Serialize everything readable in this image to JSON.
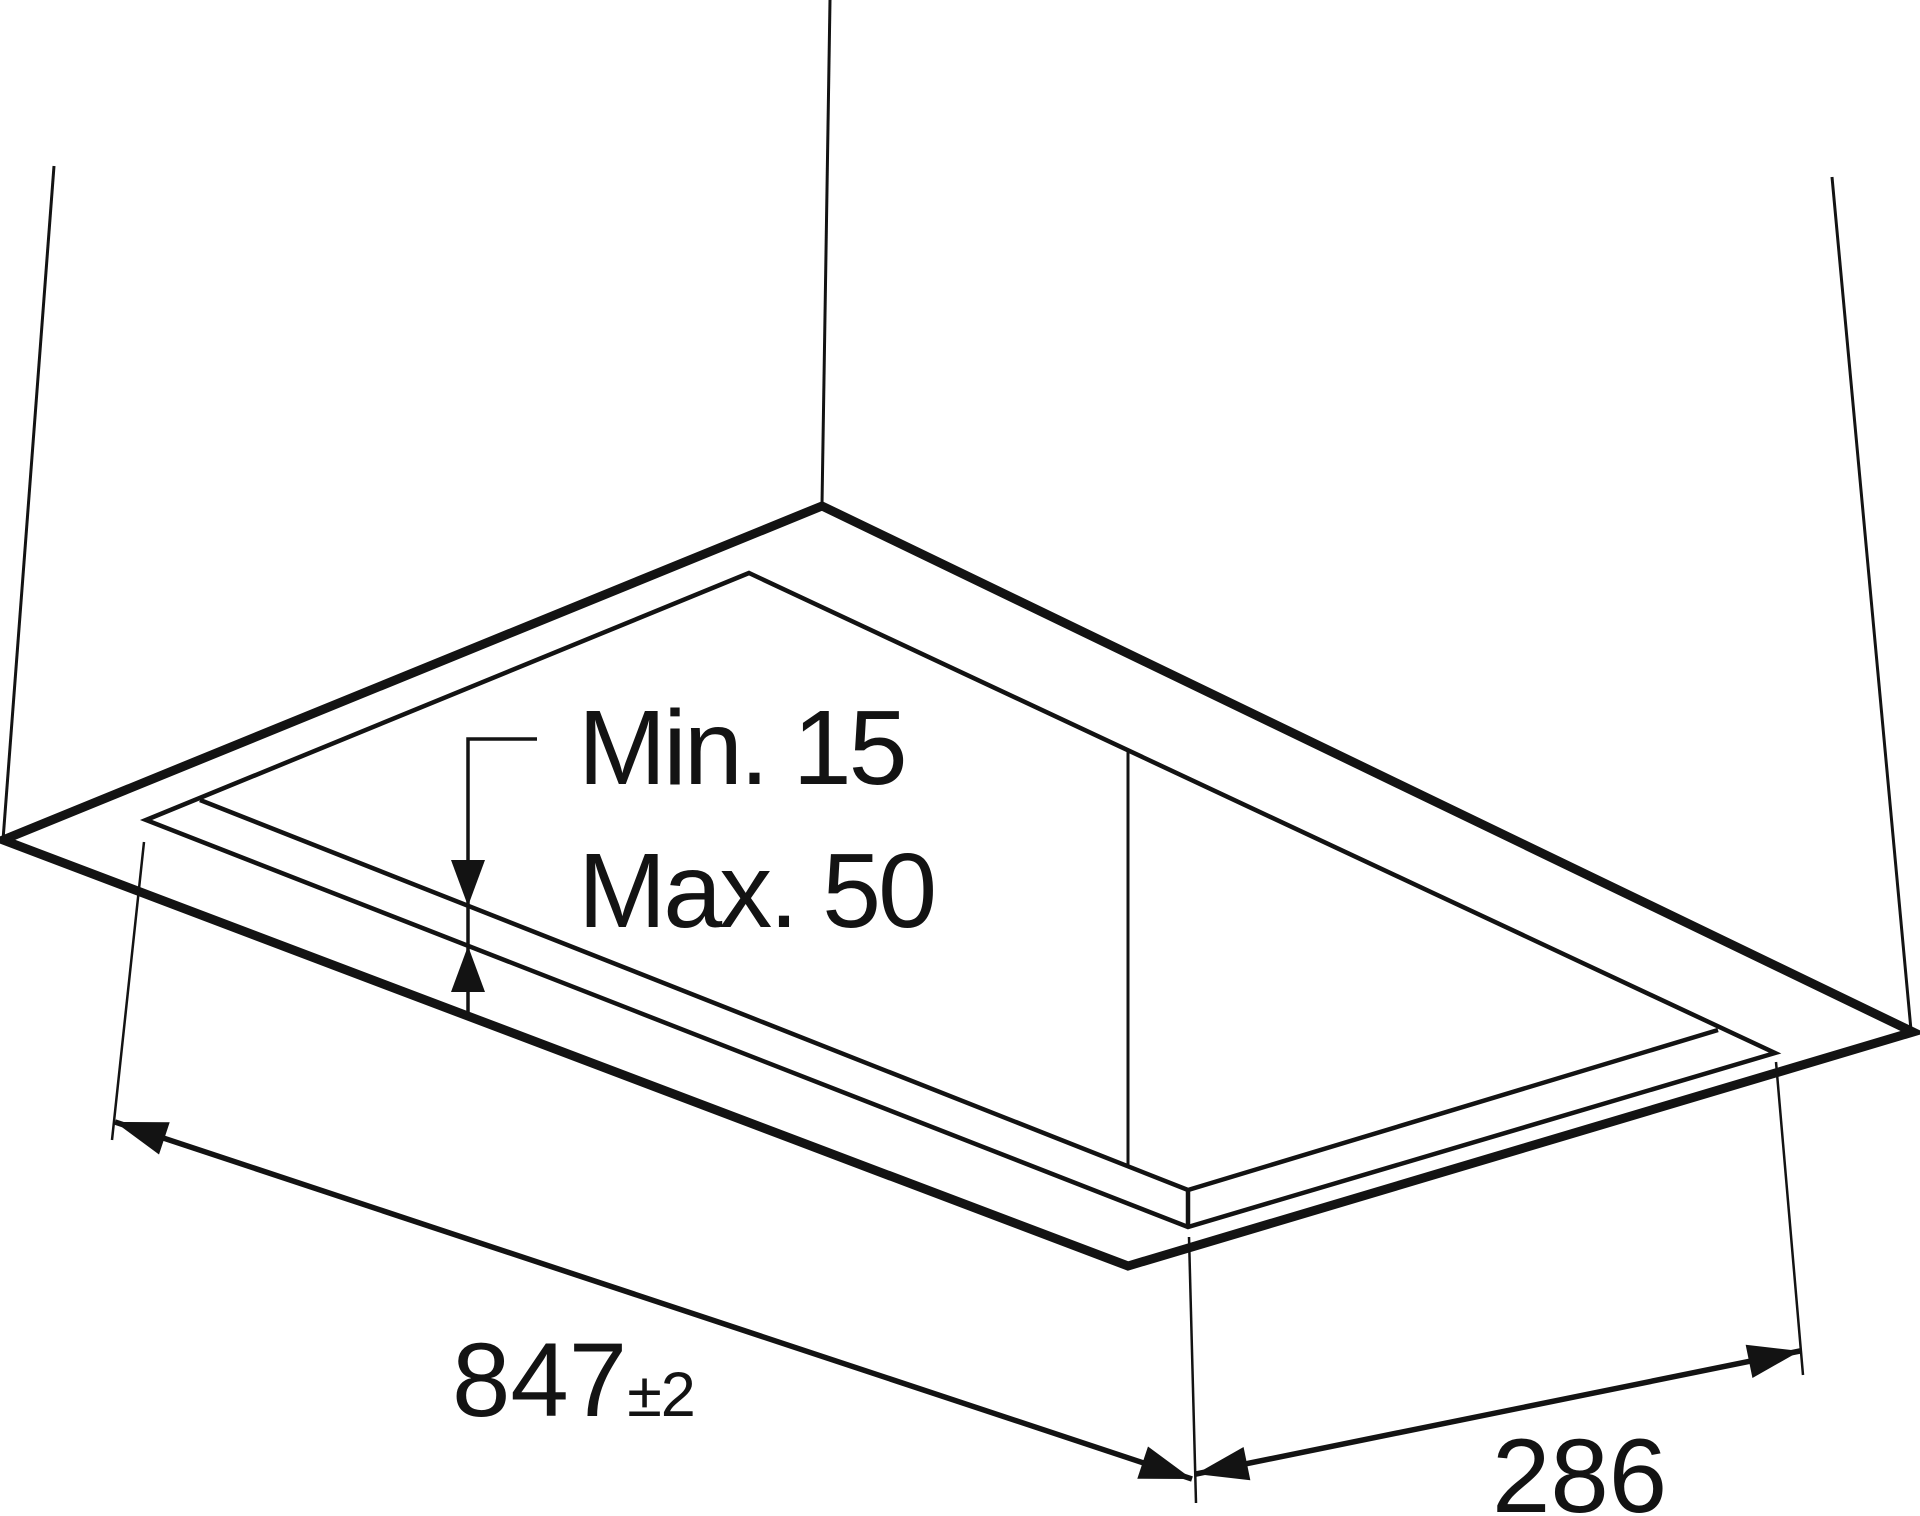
{
  "title": "Ceiling cutout installation drawing",
  "canvas": {
    "width": 1920,
    "height": 1516,
    "background": "#ffffff",
    "line_color": "#131313",
    "text_color": "#131313"
  },
  "annotations": {
    "thickness_min_label": "Min. 15",
    "thickness_max_label": "Max. 50",
    "length_value": "847",
    "length_tolerance": "±2",
    "depth_value": "286"
  },
  "drawing": {
    "polylines": [
      {
        "name": "suspension-line-top",
        "points": [
          [
            830,
            0
          ],
          [
            822,
            505
          ]
        ],
        "width": 3
      },
      {
        "name": "suspension-line-left",
        "points": [
          [
            54,
            166
          ],
          [
            3,
            840
          ]
        ],
        "width": 3
      },
      {
        "name": "suspension-line-right",
        "points": [
          [
            1832,
            177
          ],
          [
            1911,
            1030
          ]
        ],
        "width": 3
      },
      {
        "name": "ceiling-opening-outer",
        "points": [
          [
            822,
            506
          ],
          [
            1913,
            1032
          ],
          [
            1128,
            1266
          ],
          [
            3,
            840
          ]
        ],
        "width": 9,
        "closed": true
      },
      {
        "name": "cutout-rim-upper",
        "points": [
          [
            749,
            573
          ],
          [
            1775,
            1053
          ],
          [
            1188,
            1227
          ],
          [
            146,
            820
          ]
        ],
        "width": 4.5,
        "closed": true
      },
      {
        "name": "cutout-rim-inner",
        "points": [
          [
            200,
            800
          ],
          [
            1188,
            1190
          ],
          [
            1718,
            1030
          ]
        ],
        "width": 4.5
      },
      {
        "name": "rim-corner-edge",
        "points": [
          [
            1188,
            1190
          ],
          [
            1188,
            1227
          ]
        ],
        "width": 4.5
      },
      {
        "name": "recess-corner-edge",
        "points": [
          [
            1128,
            750
          ],
          [
            1128,
            1167
          ]
        ],
        "width": 3
      },
      {
        "name": "thickness-leader",
        "points": [
          [
            537,
            739
          ],
          [
            468,
            739
          ],
          [
            468,
            1012
          ]
        ],
        "width": 3.5
      },
      {
        "name": "extension-line-left",
        "points": [
          [
            144,
            842
          ],
          [
            112,
            1140
          ]
        ],
        "width": 2.5
      },
      {
        "name": "extension-line-bottom",
        "points": [
          [
            1189,
            1237
          ],
          [
            1196,
            1503
          ]
        ],
        "width": 2.5
      },
      {
        "name": "extension-line-right",
        "points": [
          [
            1776,
            1062
          ],
          [
            1803,
            1375
          ]
        ],
        "width": 2.5
      },
      {
        "name": "dimension-line-length",
        "points": [
          [
            115,
            1122
          ],
          [
            1192,
            1479
          ]
        ],
        "width": 5.5
      },
      {
        "name": "dimension-line-depth",
        "points": [
          [
            1196,
            1474
          ],
          [
            1800,
            1351
          ]
        ],
        "width": 5.5
      }
    ],
    "arrowheads": [
      {
        "name": "arrowhead-length-left",
        "tip": [
          115,
          1122
        ],
        "along": [
          1192,
          1479
        ],
        "length": 52,
        "half_width": 17
      },
      {
        "name": "arrowhead-length-right",
        "tip": [
          1192,
          1479
        ],
        "along": [
          115,
          1122
        ],
        "length": 52,
        "half_width": 17
      },
      {
        "name": "arrowhead-depth-left",
        "tip": [
          1196,
          1474
        ],
        "along": [
          1800,
          1351
        ],
        "length": 52,
        "half_width": 17
      },
      {
        "name": "arrowhead-depth-right",
        "tip": [
          1800,
          1351
        ],
        "along": [
          1196,
          1474
        ],
        "length": 52,
        "half_width": 17
      },
      {
        "name": "arrowhead-thickness-down",
        "tip": [
          468,
          906
        ],
        "along": [
          468,
          739
        ],
        "length": 46,
        "half_width": 17
      },
      {
        "name": "arrowhead-thickness-up",
        "tip": [
          468,
          946
        ],
        "along": [
          468,
          1012
        ],
        "length": 46,
        "half_width": 17
      }
    ]
  }
}
